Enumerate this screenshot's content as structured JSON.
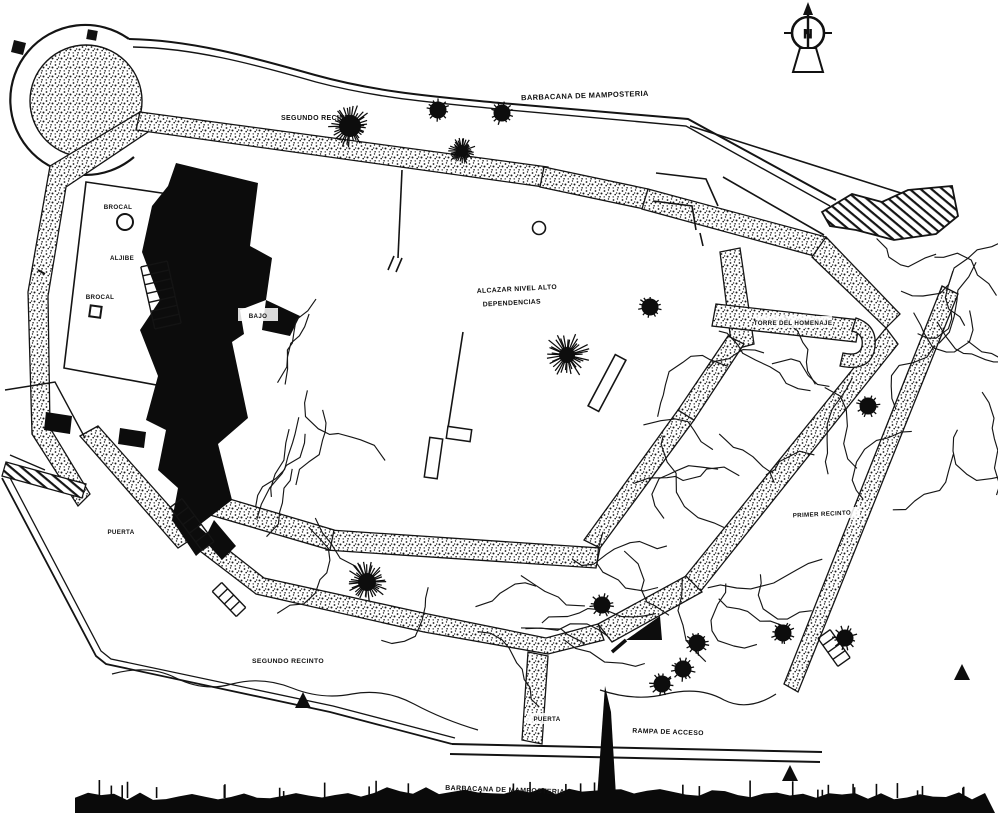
{
  "plan": {
    "labels": {
      "barbacana_top": "BARBACANA DE MAMPOSTERIA",
      "segundo_recinto_top": "SEGUNDO RECINTO",
      "brocal_upper": "BROCAL",
      "aljibe": "ALJIBE",
      "brocal_lower": "BROCAL",
      "alcazar_line1": "ALCAZAR NIVEL ALTO",
      "alcazar_line2": "DEPENDENCIAS",
      "nivel_bajo": "BAJO",
      "torre_homenaje": "TORRE DEL HOMENAJE",
      "primer_recinto": "PRIMER RECINTO",
      "puerta_west": "PUERTA",
      "segundo_recinto_bottom": "SEGUNDO RECINTO",
      "puerta_south": "PUERTA",
      "rampa_acceso": "RAMPA DE ACCESO",
      "barbacana_bottom": "BARBACANA DE MAMPOSTERIA"
    },
    "compass": {
      "letter": "N"
    },
    "colors": {
      "ink": "#111111",
      "paper": "#ffffff"
    }
  }
}
